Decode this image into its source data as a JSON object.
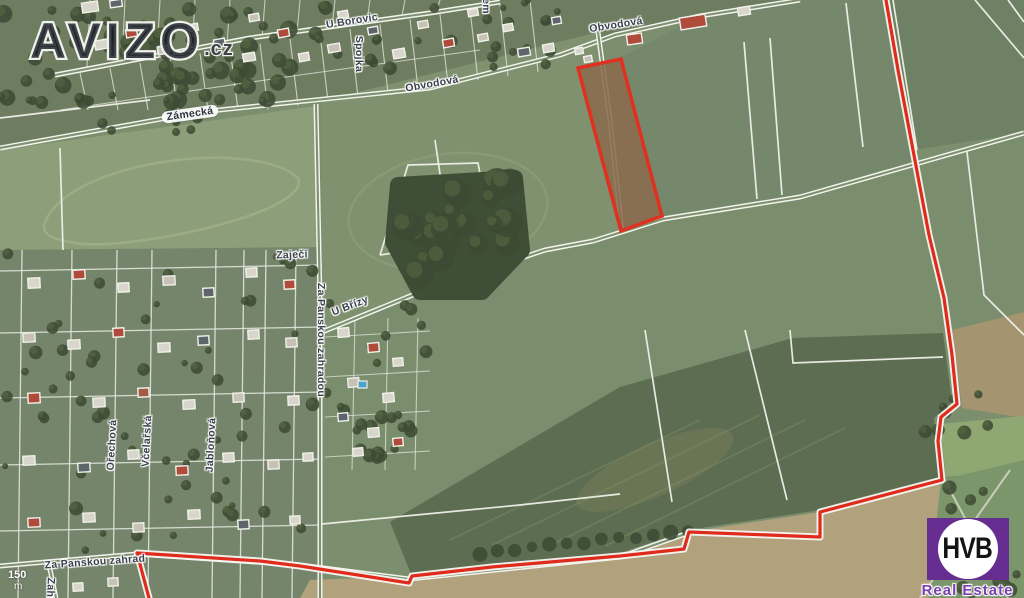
{
  "watermark": {
    "text": "AVIZO",
    "suffix": ".cz"
  },
  "logo": {
    "abbr": "HVB",
    "caption": "Real Estate",
    "color": "#662e91"
  },
  "scale_bar": {
    "distance": "150",
    "unit": "m"
  },
  "colors": {
    "field_green": "#7b8e6e",
    "field_light": "#8d9f7a",
    "field_dark": "#5c6d51",
    "forest": "#3d4b34",
    "tan": "#b1a17c",
    "road_white": "#f2f4ee",
    "boundary_red": "#df2b1c",
    "parcel_fill": "#8a6b4e",
    "label_text": "#3a414d"
  },
  "streets": [
    {
      "name": "U Borovic",
      "x": 352,
      "y": 21,
      "rot": -9
    },
    {
      "name": "Spojka",
      "x": 359,
      "y": 54,
      "rot": 90
    },
    {
      "name": "Obvodová",
      "x": 432,
      "y": 84,
      "rot": -10
    },
    {
      "name": "Obvodová",
      "x": 616,
      "y": 25,
      "rot": -9
    },
    {
      "name": "Zámecká",
      "x": 190,
      "y": 114,
      "rot": -8,
      "pill": true
    },
    {
      "name": "Zaječí",
      "x": 292,
      "y": 255,
      "rot": -2
    },
    {
      "name": "Za Panskou zahradou",
      "x": 321,
      "y": 340,
      "rot": 90
    },
    {
      "name": "U Břízy",
      "x": 350,
      "y": 306,
      "rot": -21
    },
    {
      "name": "Ořechová",
      "x": 112,
      "y": 445,
      "rot": -87
    },
    {
      "name": "Včelařská",
      "x": 147,
      "y": 441,
      "rot": -87
    },
    {
      "name": "Jabloňová",
      "x": 211,
      "y": 445,
      "rot": -87
    },
    {
      "name": "Za Panskou zahrad",
      "x": 95,
      "y": 562,
      "rot": -4
    },
    {
      "name": "Zahradní",
      "x": 50,
      "y": 601,
      "rot": 92
    },
    {
      "name": "em",
      "x": 486,
      "y": 6,
      "rot": 90
    }
  ],
  "parcel": {
    "stroke": "#e0301f",
    "fill": "#8a6b4e",
    "points": [
      [
        578,
        68
      ],
      [
        621,
        59
      ],
      [
        662,
        216
      ],
      [
        621,
        231
      ]
    ]
  },
  "red_boundary": {
    "stroke": "#df2b1c",
    "points": [
      [
        886,
        0
      ],
      [
        898,
        70
      ],
      [
        913,
        150
      ],
      [
        929,
        235
      ],
      [
        944,
        298
      ],
      [
        952,
        355
      ],
      [
        957,
        404
      ],
      [
        941,
        417
      ],
      [
        938,
        441
      ],
      [
        942,
        480
      ],
      [
        820,
        512
      ],
      [
        820,
        537
      ],
      [
        689,
        532
      ],
      [
        684,
        549
      ],
      [
        620,
        556
      ],
      [
        492,
        567
      ],
      [
        412,
        576
      ],
      [
        409,
        583
      ],
      [
        300,
        566
      ],
      [
        260,
        561
      ],
      [
        137,
        553
      ],
      [
        149,
        598
      ]
    ]
  }
}
